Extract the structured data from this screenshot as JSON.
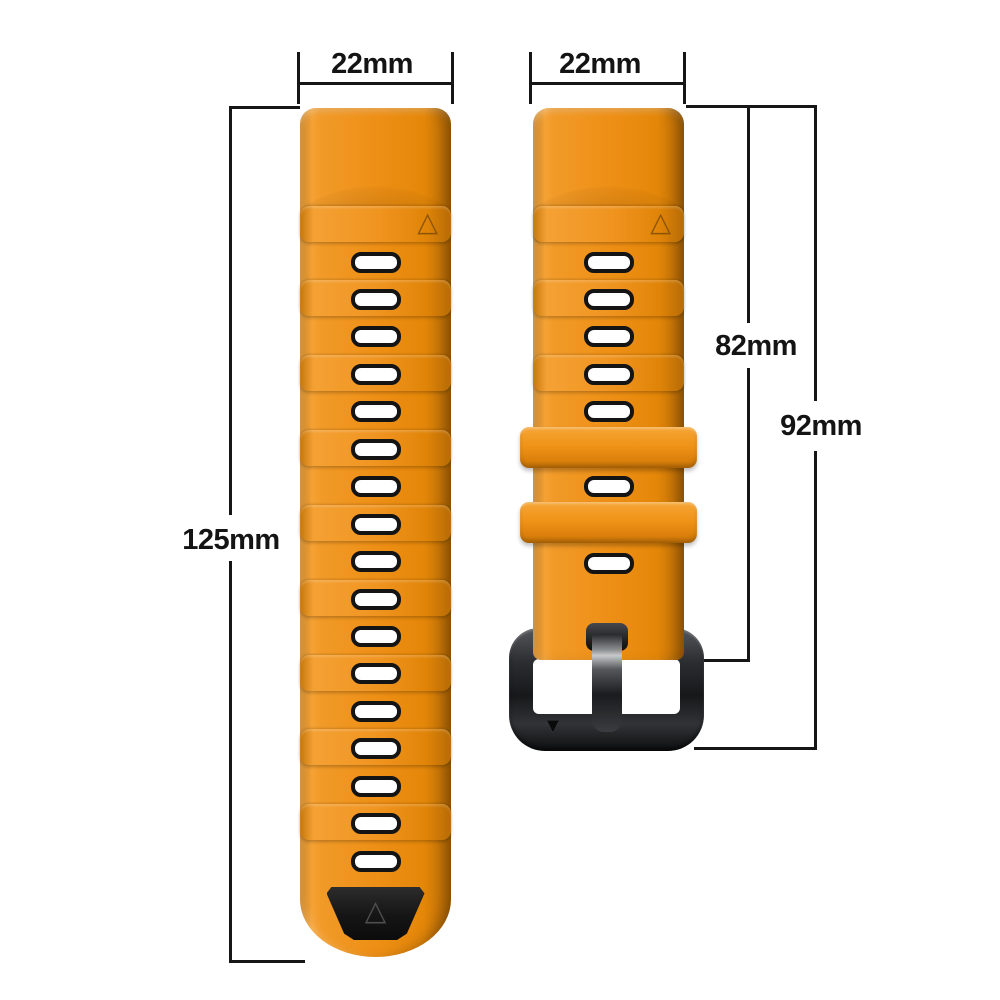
{
  "labels": {
    "left_strap_width": "22mm",
    "right_strap_width": "22mm",
    "left_strap_length": "125mm",
    "right_strap_length_to_buckle": "82mm",
    "right_strap_length_total": "92mm"
  },
  "straps": {
    "left": {
      "description": "long tail strap with holes",
      "hole_count": 17,
      "ridge_count": 8,
      "has_triangle_band": true,
      "has_black_tip_marker": true
    },
    "right": {
      "description": "buckle-side strap",
      "hole_count": 7,
      "ridge_count": 2,
      "keeper_count": 2,
      "has_triangle_band": true,
      "has_buckle": true
    }
  },
  "icons": {
    "up_triangle": "△",
    "down_triangle": "▼"
  },
  "colors": {
    "background": "#ffffff",
    "strap_orange": "#ee8f15",
    "strap_highlight": "#f5a133",
    "strap_shadow": "#b96c06",
    "hole_border": "#141414",
    "hole_fill": "#ffffff",
    "buckle_dark": "#232528",
    "tip_black": "#151515",
    "dimension_line": "#161616",
    "label_text": "#141414"
  }
}
